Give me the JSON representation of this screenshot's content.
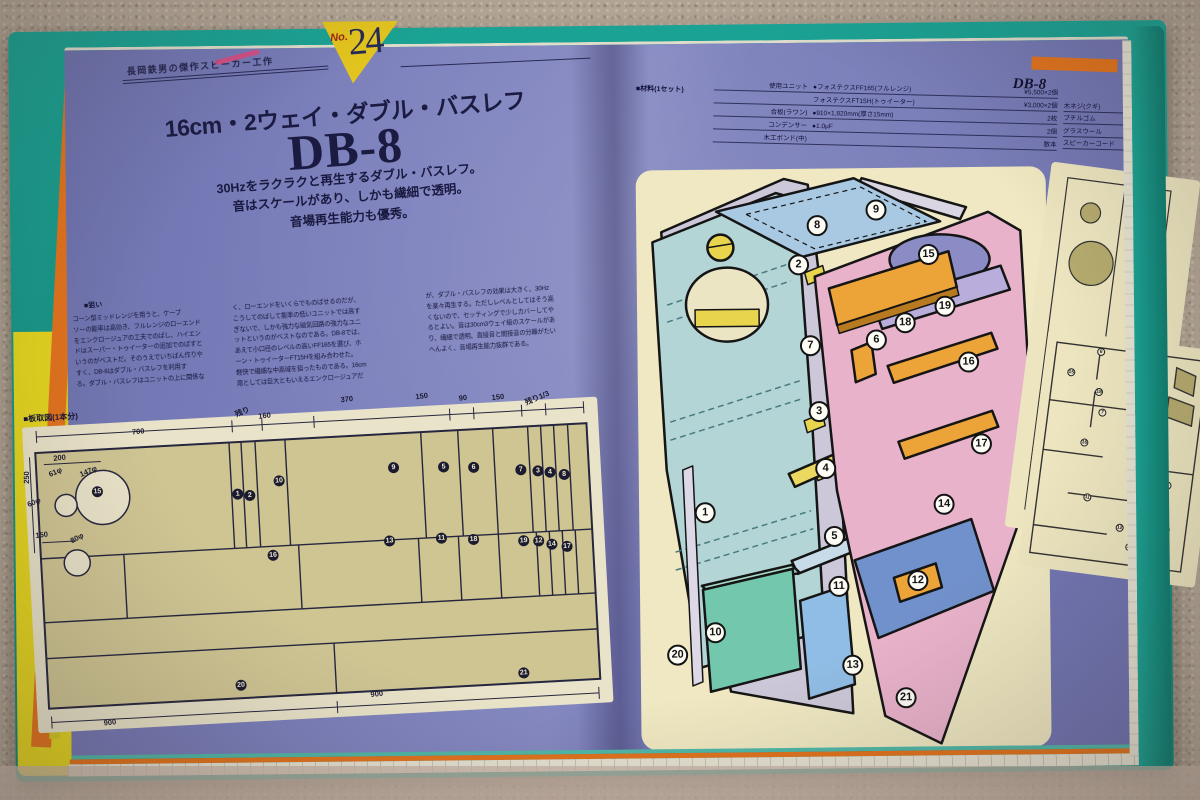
{
  "page_label": "DB-8",
  "badge": {
    "no": "No.",
    "number": "24"
  },
  "header": {
    "series": "長岡鉄男の傑作スピーカー工作"
  },
  "title": {
    "spec": "16cm・2ウェイ・ダブル・バスレフ",
    "model": "DB-8"
  },
  "subtitle": {
    "line1": "30Hzをラクラクと再生するダブル・バスレフ。",
    "line2": "音はスケールがあり、しかも繊細で透明。",
    "line3": "音場再生能力も優秀。"
  },
  "body": {
    "heading": "■狙い",
    "col1": "コーン型ミッドレンジを用うと、ケーブ\nソーの能率は高効き、フルレンジのローエンド\nをエンクロージュアの工夫でのばし、ハイエン\nドはスーパー・トゥイーターの追加でのばすと\nいうのがベストだ。そのうえでいちばん作りや\nすく、DB-8はダブル・バスレフを利用す\nる。ダブル・バスレフはユニットの上に関係な",
    "col2": "く、ローエンドをいくらでものばせるのだが、\nこうしてのばして能率の低いユニットでは高す\nぎないで、しかも強力な磁気回路の強力なユニ\nットというのがベストなのである。DB-8では、\nあえて小口径のレベルの高いFF165を選び、ホ\nーン・トゥイーターFT15Hを組み合わせた。\n軽快で繊細な中高域を狙ったものである。16cm\n用としては巨大ともいえるエンクロージュアだ",
    "col3": "が、ダブル・バスレフの効果は大きく、30Hz\nを楽々再生する。ただしレベルとしてはそう高\nくないので、セッティングで少しカバーしてや\nるとよい。音は30cm3ウェイ級のスケールがあ\nり、繊細で透明、直接音と間接音の分離がたい\nへんよく、音場再生能力抜群である。"
  },
  "cutting": {
    "label": "■板取図(1本分)",
    "numbers": [
      {
        "n": "15",
        "x": 72,
        "y": 82
      },
      {
        "n": "1",
        "x": 212,
        "y": 92
      },
      {
        "n": "2",
        "x": 224,
        "y": 94
      },
      {
        "n": "10",
        "x": 254,
        "y": 81
      },
      {
        "n": "9",
        "x": 369,
        "y": 74
      },
      {
        "n": "5",
        "x": 419,
        "y": 76
      },
      {
        "n": "6",
        "x": 449,
        "y": 78
      },
      {
        "n": "7",
        "x": 496,
        "y": 83
      },
      {
        "n": "3",
        "x": 513,
        "y": 85
      },
      {
        "n": "4",
        "x": 525,
        "y": 87
      },
      {
        "n": "8",
        "x": 539,
        "y": 90
      },
      {
        "n": "16",
        "x": 244,
        "y": 155
      },
      {
        "n": "13",
        "x": 361,
        "y": 147
      },
      {
        "n": "11",
        "x": 413,
        "y": 147
      },
      {
        "n": "18",
        "x": 445,
        "y": 150
      },
      {
        "n": "19",
        "x": 495,
        "y": 154
      },
      {
        "n": "12",
        "x": 510,
        "y": 155
      },
      {
        "n": "14",
        "x": 523,
        "y": 159
      },
      {
        "n": "17",
        "x": 538,
        "y": 162
      },
      {
        "n": "20",
        "x": 205,
        "y": 283
      },
      {
        "n": "21",
        "x": 488,
        "y": 286
      }
    ],
    "dims": [
      {
        "t": "700",
        "x": 116,
        "y": 24,
        "r": -3
      },
      {
        "t": "残り",
        "x": 221,
        "y": 10,
        "r": -20
      },
      {
        "t": "160",
        "x": 243,
        "y": 15,
        "r": -3
      },
      {
        "t": "370",
        "x": 326,
        "y": 3,
        "r": -3
      },
      {
        "t": "150",
        "x": 401,
        "y": 4,
        "r": -3
      },
      {
        "t": "90",
        "x": 442,
        "y": 8,
        "r": -3
      },
      {
        "t": "150",
        "x": 477,
        "y": 9,
        "r": -3
      },
      {
        "t": "残り1/3",
        "x": 516,
        "y": 12,
        "r": -20
      },
      {
        "t": "250",
        "x": 2,
        "y": 64,
        "r": -87
      },
      {
        "t": "200",
        "x": 36,
        "y": 46,
        "r": -3
      },
      {
        "t": "61φ",
        "x": 31,
        "y": 60,
        "r": -20
      },
      {
        "t": "147φ",
        "x": 64,
        "y": 61,
        "r": -20
      },
      {
        "t": "60φ",
        "x": 8,
        "y": 89,
        "r": -20
      },
      {
        "t": "150",
        "x": 14,
        "y": 122,
        "r": -3
      },
      {
        "t": "80φ",
        "x": 49,
        "y": 127,
        "r": -25
      },
      {
        "t": "900",
        "x": 72,
        "y": 313,
        "r": -3
      },
      {
        "t": "900",
        "x": 340,
        "y": 299,
        "r": -3
      }
    ]
  },
  "parts_table": {
    "label": "■材料(1セット)",
    "left_rows": [
      {
        "label": "使用ユニット",
        "detail": "●フォステクスFF165(フルレンジ)",
        "value": "¥5,500×2個"
      },
      {
        "label": "",
        "detail": "フォステクスFT15H(トゥイーター)",
        "value": "¥3,000×2個"
      },
      {
        "label": "合板(ラワン)",
        "detail": "●910×1,820mm(厚さ15mm)",
        "value": "2枚"
      },
      {
        "label": "コンデンサー",
        "detail": "●1.0μF",
        "value": "2個"
      },
      {
        "label": "木工ボンド(中)",
        "detail": "",
        "value": "数本"
      }
    ],
    "right_rows": [
      {
        "label": "木ネジ(クギ)",
        "value": "50mm"
      },
      {
        "label": "ブチルゴム",
        "value": "2個"
      },
      {
        "label": "グラスウール",
        "value": "少量"
      },
      {
        "label": "スピーカーコード",
        "value": ""
      }
    ]
  },
  "exploded": {
    "numbers": [
      {
        "n": "8",
        "x": 181,
        "y": 57
      },
      {
        "n": "9",
        "x": 240,
        "y": 42
      },
      {
        "n": "2",
        "x": 162,
        "y": 96
      },
      {
        "n": "15",
        "x": 292,
        "y": 87
      },
      {
        "n": "19",
        "x": 308,
        "y": 139
      },
      {
        "n": "18",
        "x": 268,
        "y": 155
      },
      {
        "n": "6",
        "x": 239,
        "y": 172
      },
      {
        "n": "7",
        "x": 173,
        "y": 177
      },
      {
        "n": "16",
        "x": 331,
        "y": 195
      },
      {
        "n": "3",
        "x": 181,
        "y": 243
      },
      {
        "n": "17",
        "x": 343,
        "y": 277
      },
      {
        "n": "4",
        "x": 187,
        "y": 300
      },
      {
        "n": "1",
        "x": 66,
        "y": 343
      },
      {
        "n": "14",
        "x": 305,
        "y": 337
      },
      {
        "n": "5",
        "x": 195,
        "y": 368
      },
      {
        "n": "11",
        "x": 199,
        "y": 418
      },
      {
        "n": "12",
        "x": 278,
        "y": 413
      },
      {
        "n": "10",
        "x": 75,
        "y": 463
      },
      {
        "n": "20",
        "x": 37,
        "y": 485
      },
      {
        "n": "13",
        "x": 212,
        "y": 497
      },
      {
        "n": "21",
        "x": 265,
        "y": 530
      }
    ]
  },
  "side_a": {
    "numbers": [
      {
        "n": "17",
        "x": 102,
        "y": 120
      },
      {
        "n": "9",
        "x": 88,
        "y": 172
      },
      {
        "n": "14",
        "x": 104,
        "y": 230
      },
      {
        "n": "8",
        "x": 70,
        "y": 262
      }
    ]
  },
  "side_b": {
    "numbers": [
      {
        "n": "6",
        "x": 55,
        "y": 16
      },
      {
        "n": "15",
        "x": 28,
        "y": 40
      },
      {
        "n": "2",
        "x": 118,
        "y": 30
      },
      {
        "n": "18",
        "x": 58,
        "y": 56
      },
      {
        "n": "7",
        "x": 64,
        "y": 76
      },
      {
        "n": "3",
        "x": 102,
        "y": 92
      },
      {
        "n": "16",
        "x": 50,
        "y": 108
      },
      {
        "n": "4",
        "x": 110,
        "y": 126
      },
      {
        "n": "1",
        "x": 138,
        "y": 140
      },
      {
        "n": "5",
        "x": 106,
        "y": 150
      },
      {
        "n": "11",
        "x": 60,
        "y": 162
      },
      {
        "n": "10",
        "x": 120,
        "y": 176
      },
      {
        "n": "12",
        "x": 96,
        "y": 188
      },
      {
        "n": "14",
        "x": 142,
        "y": 184
      },
      {
        "n": "13",
        "x": 108,
        "y": 206
      }
    ]
  },
  "colors": {
    "page_purple": "#7a7eba",
    "cover_teal": "#17a191",
    "edge_orange": "#e2731d",
    "edge_yellow": "#d6ca22",
    "cream_panel": "#efe8c2",
    "board_beige": "#cfc593",
    "ink_navy": "#1b1b42",
    "badge_yellow": "#e3c41e",
    "panel_teal": "#b4d5d5",
    "panel_pink": "#e9b2cb",
    "panel_blue": "#a9c9e3",
    "brace_orange": "#eca338",
    "floor_blue": "#7191cc",
    "box_teal": "#73c7ad",
    "shelf_lavender": "#b9addc",
    "oval_purple": "#8b8bc5"
  }
}
